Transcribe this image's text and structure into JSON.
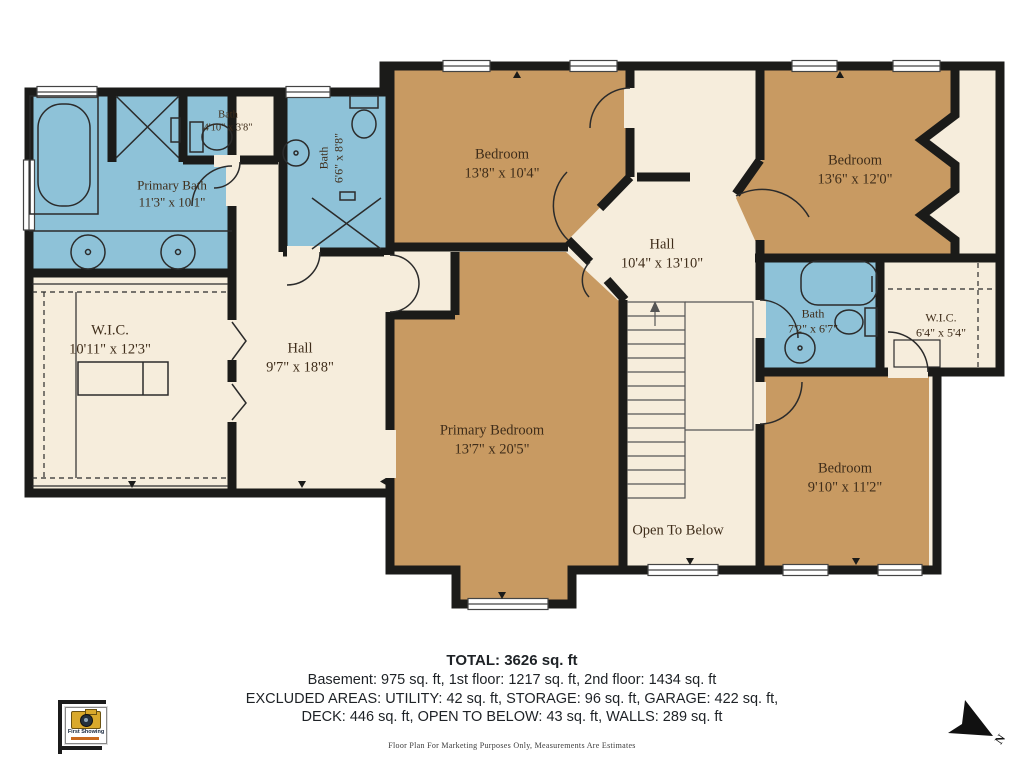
{
  "plan": {
    "rooms": {
      "primary_bath": {
        "name": "Primary Bath",
        "dims": "11'3\" x 10'1\""
      },
      "bath_small": {
        "name": "Bath",
        "dims": "4'10\" x 3'8\""
      },
      "bath_upper": {
        "name": "Bath",
        "dims": "6'6\" x 8'8\""
      },
      "bedroom_top": {
        "name": "Bedroom",
        "dims": "13'8\" x 10'4\""
      },
      "bedroom_right": {
        "name": "Bedroom",
        "dims": "13'6\" x 12'0\""
      },
      "hall_center": {
        "name": "Hall",
        "dims": "10'4\" x 13'10\""
      },
      "wic_left": {
        "name": "W.I.C.",
        "dims": "10'11\" x 12'3\""
      },
      "hall_left": {
        "name": "Hall",
        "dims": "9'7\" x 18'8\""
      },
      "primary_bedroom": {
        "name": "Primary Bedroom",
        "dims": "13'7\" x 20'5\""
      },
      "bath_right": {
        "name": "Bath",
        "dims": "7'2\" x 6'7\""
      },
      "wic_right": {
        "name": "W.I.C.",
        "dims": "6'4\" x 5'4\""
      },
      "bedroom_bottom": {
        "name": "Bedroom",
        "dims": "9'10\" x 11'2\""
      },
      "open_below": {
        "name": "Open To Below"
      }
    },
    "colors": {
      "room_tan": "#c89a62",
      "wet_blue": "#8ec2d8",
      "floor_beige": "#f6eddc",
      "wall": "#1b1b19"
    }
  },
  "footer": {
    "total": "TOTAL: 3626 sq. ft",
    "floors": "Basement: 975 sq. ft, 1st floor: 1217 sq. ft, 2nd floor: 1434 sq. ft",
    "excluded_1": "EXCLUDED AREAS: UTILITY: 42 sq. ft, STORAGE: 96 sq. ft, GARAGE: 422 sq. ft,",
    "excluded_2": "DECK: 446 sq. ft, OPEN TO BELOW: 43 sq. ft, WALLS: 289 sq. ft",
    "disclaimer": "Floor Plan For Marketing Purposes Only, Measurements Are Estimates"
  },
  "logo": {
    "brand": "First Showing"
  },
  "compass": {
    "label": "N"
  }
}
